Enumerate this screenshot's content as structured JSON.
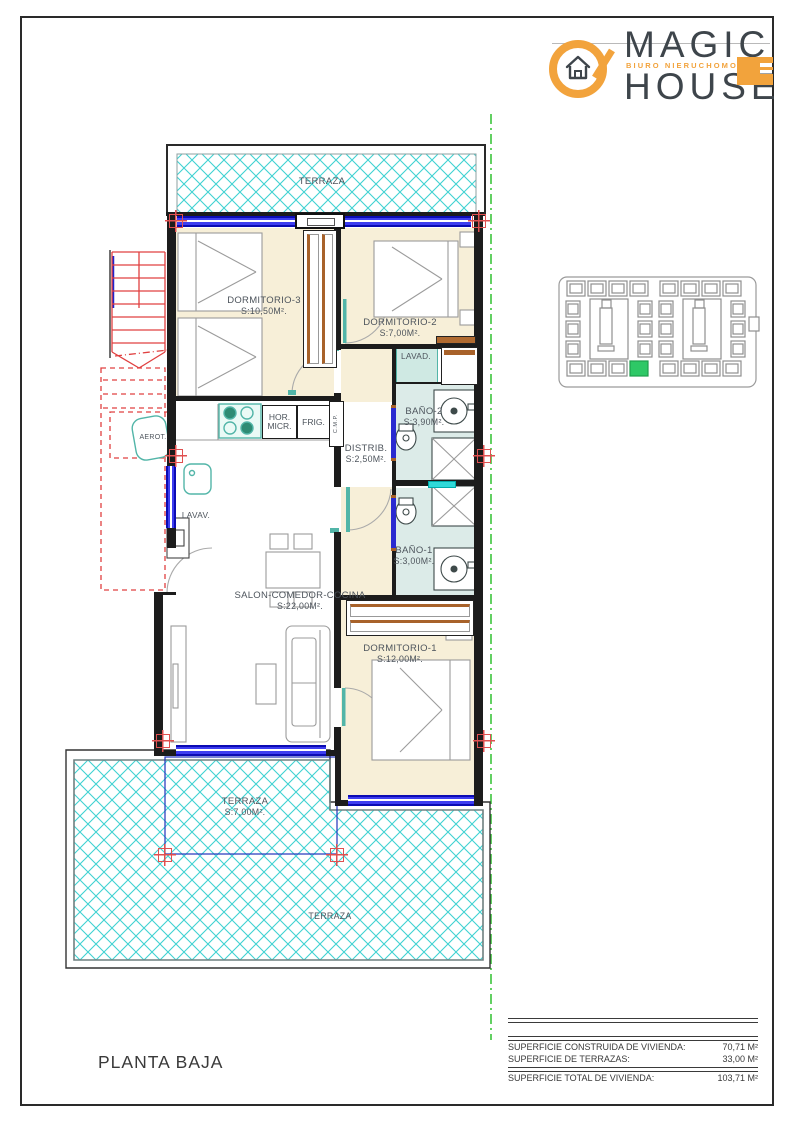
{
  "logo": {
    "magic": "MAGIC",
    "house": "HOUSE",
    "tagline": "BIURO NIERUCHOMOŚCI"
  },
  "rooms": {
    "terraza_top": {
      "name": "TERRAZA"
    },
    "dorm3": {
      "name": "DORMITORIO-3",
      "area": "S:10,50M²."
    },
    "dorm2": {
      "name": "DORMITORIO-2",
      "area": "S:7,00M²."
    },
    "lavad": {
      "name": "LAVAD."
    },
    "bano2": {
      "name": "BAÑO-2",
      "area": "S:3,90M²."
    },
    "distrib": {
      "name": "DISTRIB.",
      "area": "S:2,50M²."
    },
    "bano1": {
      "name": "BAÑO-1",
      "area": "S:3,00M²."
    },
    "salon": {
      "name": "SALON-COMEDOR-COCINA",
      "area": "S:22,00M²."
    },
    "dorm1": {
      "name": "DORMITORIO-1",
      "area": "S:12,00M²."
    },
    "terraza_front": {
      "name": "TERRAZA",
      "area": "S:7,00M²."
    },
    "terraza_front_outer": {
      "name": "TERRAZA"
    }
  },
  "appliances": {
    "hor": "HOR.",
    "micr": "MICR.",
    "frig": "FRIG.",
    "lavav": "LAVAV.",
    "aerot": "AEROT.",
    "cmp": "C.M.P."
  },
  "footer": {
    "title": "PLANTA BAJA"
  },
  "areas_table": {
    "rows": [
      {
        "label": "SUPERFICIE CONSTRUIDA DE VIVIENDA:",
        "value": "70,71 M²"
      },
      {
        "label": "SUPERFICIE DE TERRAZAS:",
        "value": "33,00 M²"
      },
      {
        "label": "SUPERFICIE TOTAL DE VIVIENDA:",
        "value": "103,71 M²"
      }
    ]
  },
  "colors": {
    "accent_orange": "#F2A33C",
    "logo_dark": "#3E454B",
    "hatch_cyan": "#3FD2D2",
    "window_blue": "#1A1AD8",
    "mark_red": "#E05050",
    "boundary_green": "#3CC43C",
    "floor_cream": "#F7EFD8",
    "floor_bath": "#DCEBE8",
    "wardrobe_brown": "#A8622A",
    "highlight_green": "#2EC866"
  }
}
